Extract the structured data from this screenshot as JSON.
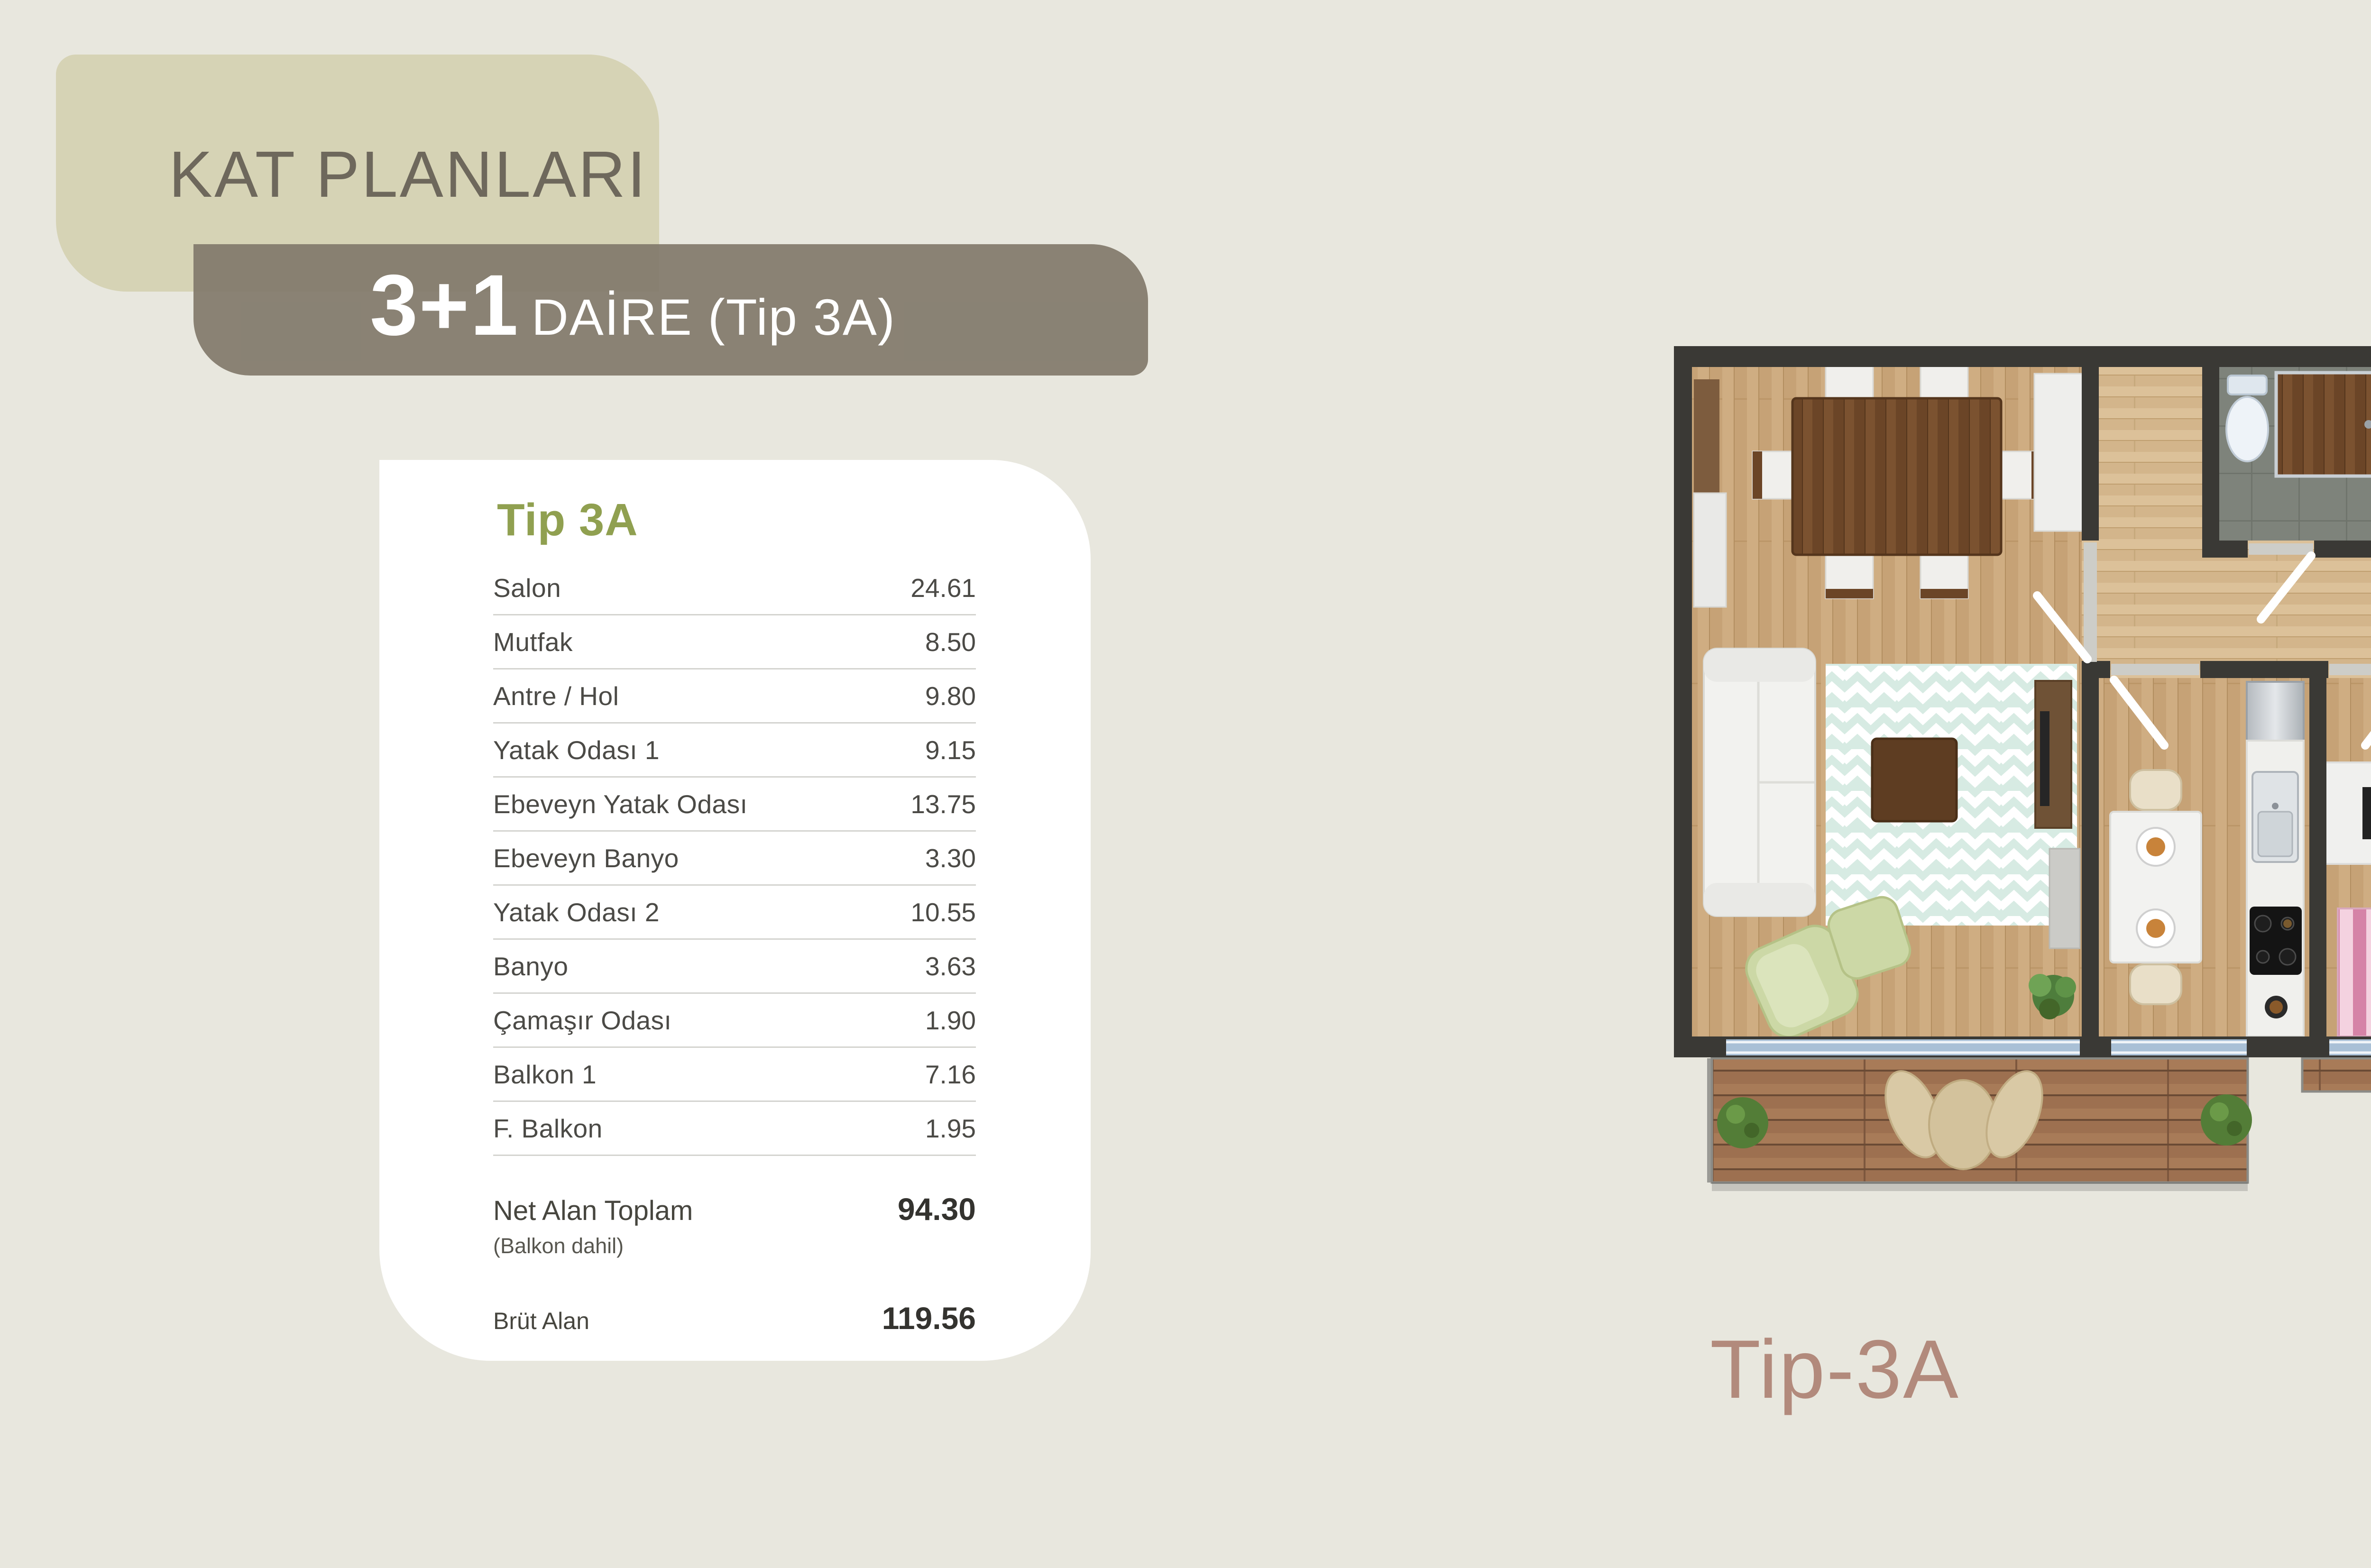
{
  "page": {
    "background_color": "#e8e7de"
  },
  "header": {
    "section_title": "KAT PLANLARI",
    "banner_title_big": "3+1",
    "banner_title_rest": "DAİRE (Tip 3A)"
  },
  "logo": {
    "brand": "esen",
    "badge_number": "11",
    "subtitle": "torbalı",
    "accent_color": "#a12346",
    "text_color": "#45413a",
    "mark": "leaf-check-icon"
  },
  "area_card": {
    "title": "Tip 3A",
    "unit": "m2",
    "rows": [
      {
        "label": "Salon",
        "value": "24.61"
      },
      {
        "label": "Mutfak",
        "value": "8.50"
      },
      {
        "label": "Antre / Hol",
        "value": "9.80"
      },
      {
        "label": "Yatak Odası 1",
        "value": "9.15"
      },
      {
        "label": "Ebeveyn Yatak Odası",
        "value": "13.75"
      },
      {
        "label": "Ebeveyn Banyo",
        "value": "3.30"
      },
      {
        "label": "Yatak Odası 2",
        "value": "10.55"
      },
      {
        "label": "Banyo",
        "value": "3.63"
      },
      {
        "label": "Çamaşır Odası",
        "value": "1.90"
      },
      {
        "label": "Balkon 1",
        "value": "7.16"
      },
      {
        "label": "F. Balkon",
        "value": "1.95"
      }
    ],
    "totals": [
      {
        "label": "Net Alan Toplam",
        "note": "(Balkon dahil)",
        "value": "94.30"
      },
      {
        "label": "Brüt Alan",
        "note": "",
        "value": "119.56"
      }
    ]
  },
  "plan": {
    "caption": "Tip-3A",
    "wall_color": "#3a3935",
    "wood_color": "#cfad82",
    "hall_wood_color": "#dcc199",
    "tile_color": "#7e837b",
    "deck_color": "#a87b58",
    "rug_mint_color": "#d7ebe3",
    "rug_pink_color": "#d897ae",
    "bed_blue_color": "#7e90bb",
    "window_color": "#a9c0d6"
  }
}
